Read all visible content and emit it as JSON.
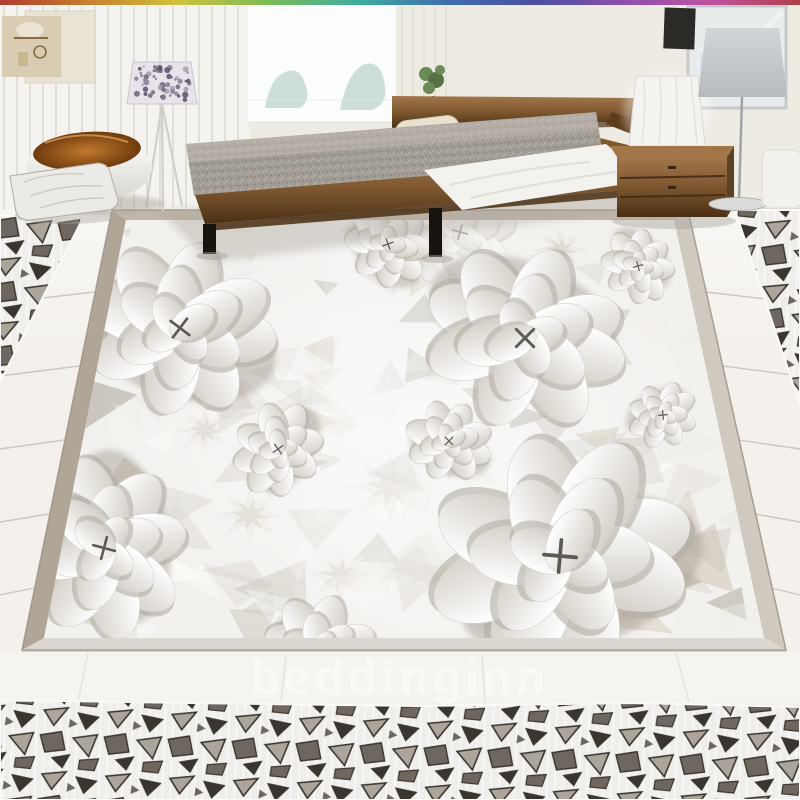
{
  "watermark": {
    "text": "beddinginn"
  },
  "palette": {
    "wall": "#f4f3ef",
    "wall_right": "#eeebe3",
    "panel_line": "#dcd8d1",
    "window_light": "#fcfdfd",
    "tree": "#c9dcd6",
    "canvas_a": "#d8cdb2",
    "canvas_b": "#e9e3d3",
    "canvas_motif": "#8a6b3e",
    "lamp_floral_bg": "#e7e3e9",
    "tripod": "#d2cfc9",
    "chair_white_lo": "#d8d5cf",
    "cushion_hi": "#c17a2c",
    "cushion_lo": "#6f3b0d",
    "pillow": "#eceae6",
    "pillow_line": "#b3ada5",
    "mattress": "#a19c94",
    "mattress_dot_dark": "#7e7870",
    "mattress_dot_lite": "#c6c1b9",
    "sheet": "#f4f2ee",
    "wood_hi": "#a3764a",
    "wood": "#7d5730",
    "wood_dark": "#4a2f13",
    "leg": "#17140f",
    "shade_grey_hi": "#d2d5d7",
    "shade_grey": "#b7bbbe",
    "lamp_white": "#f4f3f0",
    "pole": "#9fa3a5",
    "mirror": "#e9eced",
    "mirror_edge": "#c6cacb",
    "mirror_inner": "#d3e2e9",
    "art_dark": "#2c2a27",
    "plant": "#6b8a55",
    "plant_dark": "#567143",
    "tile": "#f4f1ec",
    "tile_seam": "#c9c3bb",
    "border_left": "#b0a698",
    "border_top": "#c0b7ab",
    "border_right": "#cfc9c0",
    "border_bottom": "#dcd8d1",
    "border_edge": "#97907f",
    "mural_bg": "#f3f1ee",
    "petal_lo": "#d6d1ca",
    "petal_under": "#b3ada4",
    "petal_shadow": "#a9a399",
    "flower_core": "#4e4a44",
    "carpet_bg": "#f0eeea",
    "carpet_fiber": "#fbfaf8",
    "carpet_dark": "#3a352f",
    "carpet_mid": "#6e675f",
    "carpet_lite": "#aca59b",
    "shadow": "#aaa49b",
    "rainbow": [
      "#b03a30",
      "#c87f2e",
      "#cfc33c",
      "#7dbb55",
      "#3fae9e",
      "#3f6fae",
      "#4b4fa0",
      "#8b4fae",
      "#c053a0",
      "#b04048"
    ],
    "facets": [
      "#faf9f7",
      "#efede9",
      "#e3e0da",
      "#d6d2ca",
      "#c8c3ba",
      "#bbb5aa",
      "#cfc5b4"
    ]
  },
  "mural": {
    "outer": [
      [
        112,
        210
      ],
      [
        688,
        210
      ],
      [
        786,
        650
      ],
      [
        22,
        650
      ]
    ],
    "inner": [
      [
        126,
        220
      ],
      [
        674,
        220
      ],
      [
        764,
        638
      ],
      [
        44,
        638
      ]
    ],
    "flowers": [
      {
        "x": 460,
        "y": 232,
        "r": 58,
        "rot": 80,
        "faint": true
      },
      {
        "x": 388,
        "y": 244,
        "r": 42,
        "rot": 45
      },
      {
        "x": 638,
        "y": 266,
        "r": 36,
        "rot": 230
      },
      {
        "x": 180,
        "y": 328,
        "r": 90,
        "rot": 12
      },
      {
        "x": 525,
        "y": 338,
        "r": 95,
        "rot": 200
      },
      {
        "x": 663,
        "y": 415,
        "r": 33,
        "rot": 150
      },
      {
        "x": 449,
        "y": 441,
        "r": 41,
        "rot": 20
      },
      {
        "x": 278,
        "y": 449,
        "r": 45,
        "rot": 300
      },
      {
        "x": 104,
        "y": 548,
        "r": 86,
        "rot": 260
      },
      {
        "x": 560,
        "y": 556,
        "r": 124,
        "rot": 340
      },
      {
        "x": 322,
        "y": 655,
        "r": 58,
        "rot": 60
      }
    ],
    "stars": [
      [
        390,
        487,
        46
      ],
      [
        250,
        515,
        36
      ],
      [
        480,
        300,
        34
      ],
      [
        610,
        470,
        44
      ],
      [
        205,
        430,
        30
      ],
      [
        340,
        575,
        36
      ],
      [
        560,
        250,
        28
      ]
    ]
  },
  "carpet": {
    "left_wedge": [
      [
        0,
        216
      ],
      [
        84,
        216
      ],
      [
        0,
        382
      ]
    ],
    "right_wedge": [
      [
        735,
        210
      ],
      [
        800,
        210
      ],
      [
        800,
        405
      ]
    ],
    "bottom_band": [
      [
        0,
        700
      ],
      [
        190,
        703
      ],
      [
        420,
        706
      ],
      [
        640,
        703
      ],
      [
        800,
        707
      ],
      [
        800,
        800
      ],
      [
        0,
        800
      ]
    ]
  }
}
